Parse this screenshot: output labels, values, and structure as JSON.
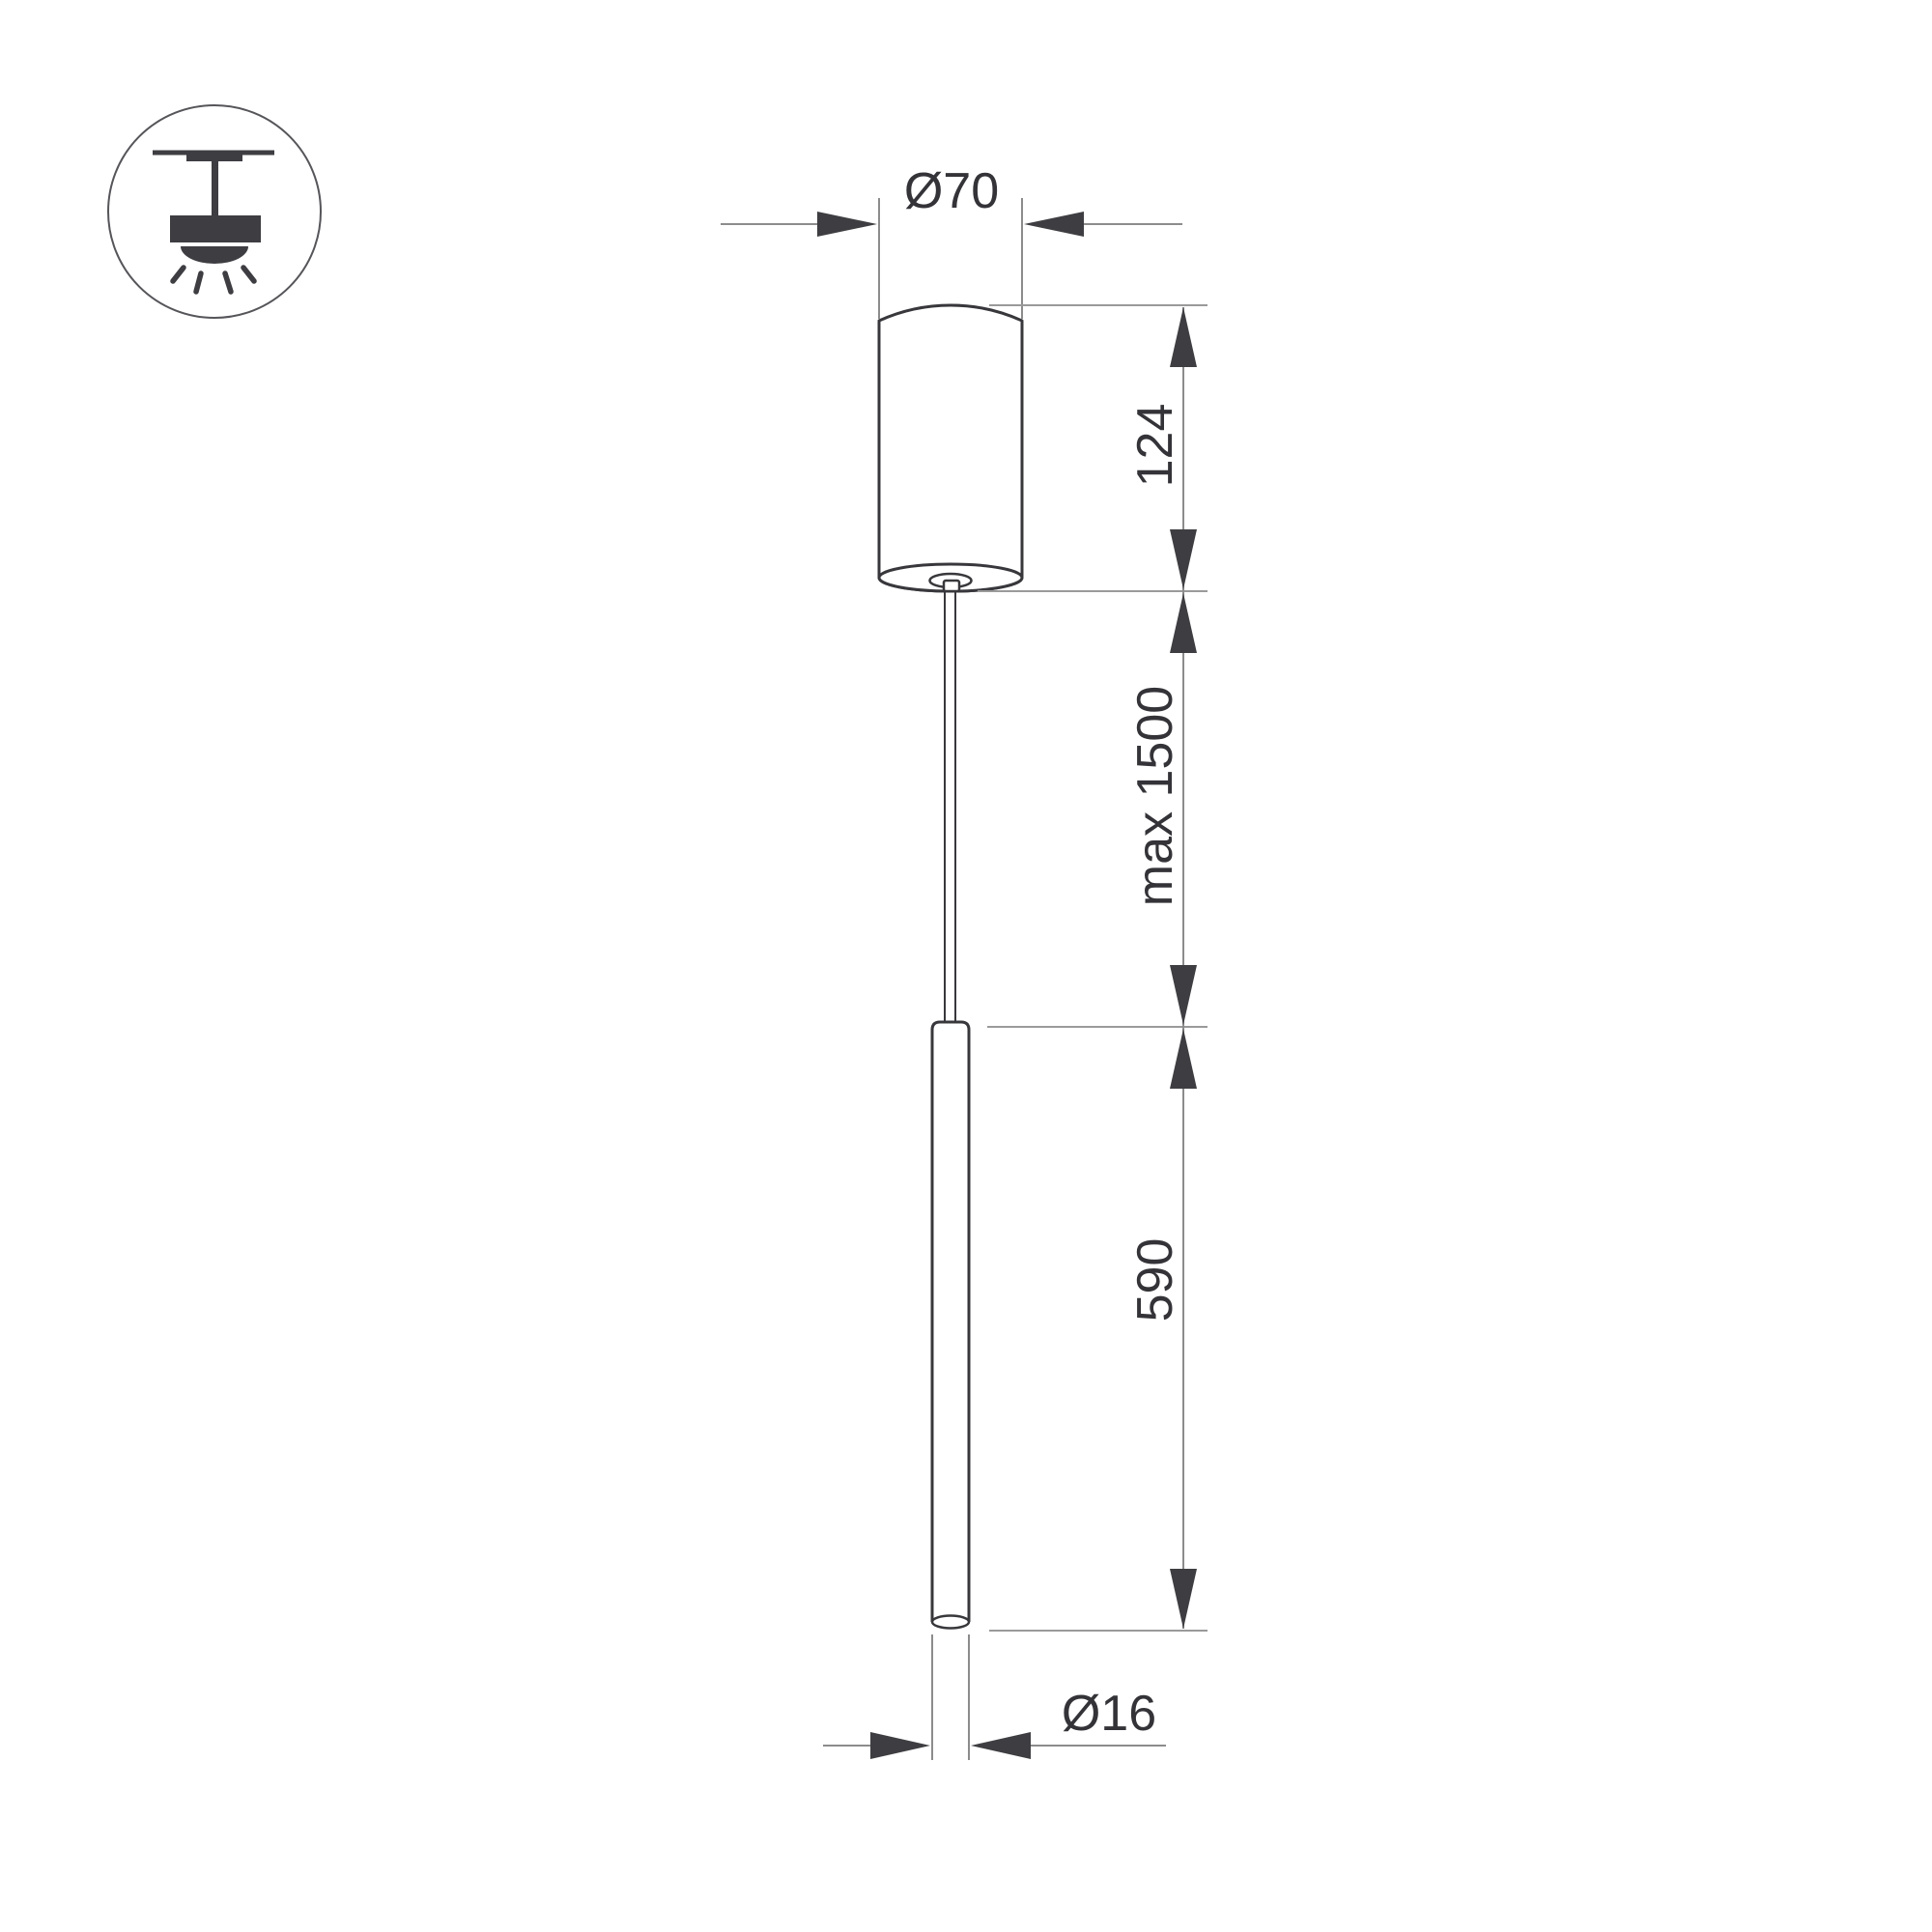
{
  "drawing": {
    "title": "pendant-luminaire-dimension-drawing",
    "dimensions": {
      "canopy_diameter": "Ø70",
      "canopy_height": "124",
      "suspension_length": "max 1500",
      "tube_length": "590",
      "tube_diameter": "Ø16"
    },
    "icon": {
      "name": "ceiling-pendant-mount-icon"
    },
    "colors": {
      "background": "#ffffff",
      "outline": "#38383c",
      "icon_fill": "#3d3d42",
      "icon_circle": "#55555a",
      "dimension_line": "#8c8c8c",
      "reference_line": "#9a9a9a",
      "extension_line": "#6f6f6f",
      "arrow": "#3e3e42",
      "text": "#333338"
    }
  }
}
